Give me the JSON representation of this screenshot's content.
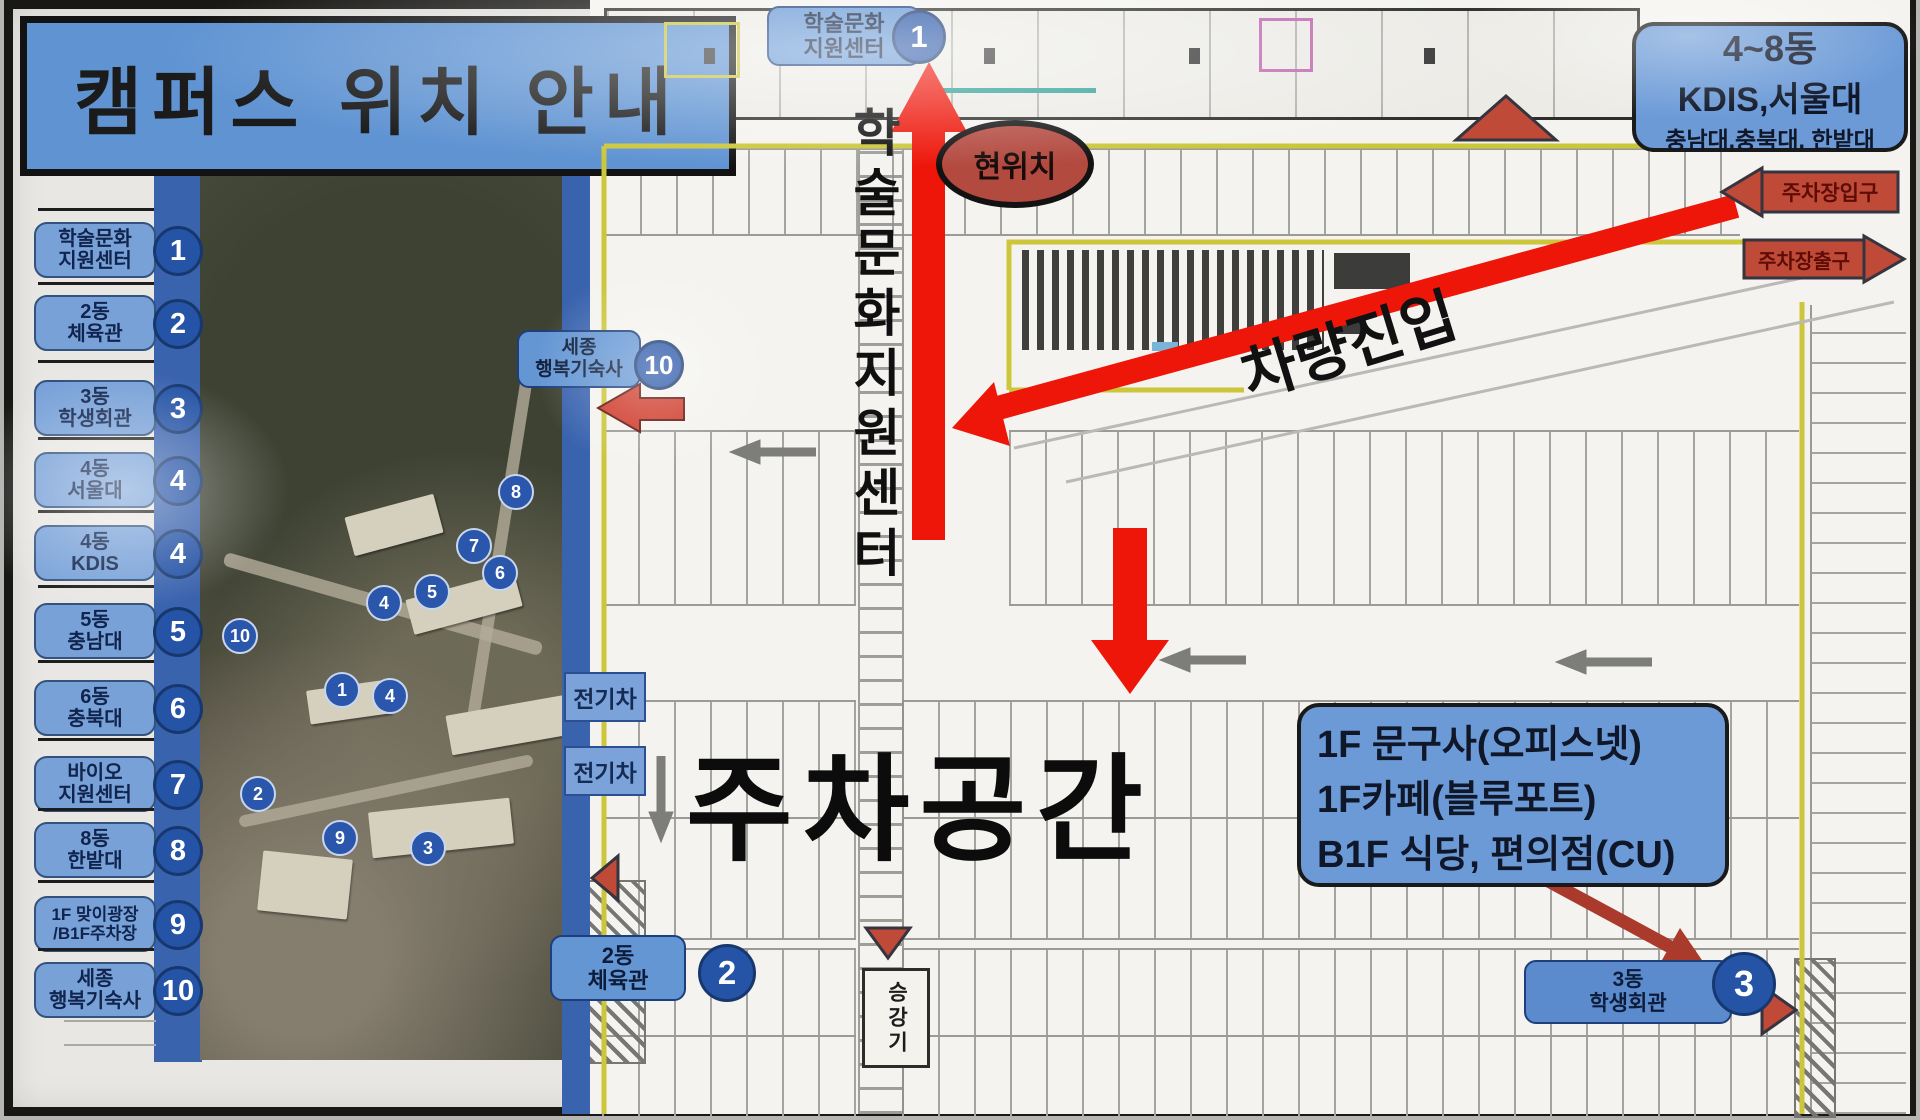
{
  "title": "캠퍼스 위치 안내",
  "legend": {
    "items": [
      {
        "line1": "학술문화",
        "line2": "지원센터",
        "num": "1"
      },
      {
        "line1": "2동",
        "line2": "체육관",
        "num": "2"
      },
      {
        "line1": "3동",
        "line2": "학생회관",
        "num": "3"
      },
      {
        "line1": "4동",
        "line2": "서울대",
        "num": "4"
      },
      {
        "line1": "4동",
        "line2": "KDIS",
        "num": "4"
      },
      {
        "line1": "5동",
        "line2": "충남대",
        "num": "5"
      },
      {
        "line1": "6동",
        "line2": "충북대",
        "num": "6"
      },
      {
        "line1": "바이오",
        "line2": "지원센터",
        "num": "7"
      },
      {
        "line1": "8동",
        "line2": "한밭대",
        "num": "8"
      },
      {
        "line1": "1F 맞이광장",
        "line2": "/B1F주차장",
        "num": "9"
      },
      {
        "line1": "세종",
        "line2": "행복기숙사",
        "num": "10"
      }
    ]
  },
  "photo": {
    "circles": [
      "10",
      "8",
      "7",
      "6",
      "5",
      "4",
      "4",
      "1",
      "2",
      "9",
      "3"
    ]
  },
  "map": {
    "top_badge": {
      "line1": "학술문화",
      "line2": "지원센터",
      "num": "1"
    },
    "current_location": "현위치",
    "vertical_route_label": "학술문화지원센터",
    "parking_area": "주차공간",
    "vehicle_entry": "차량진입",
    "entrance_label": "주차장입구",
    "exit_label": "주차장출구",
    "buildings_box": {
      "line1": "4~8동",
      "line2": "KDIS,서울대",
      "line3": "충남대,충북대, 한밭대"
    },
    "info_box": {
      "line1": "1F 문구사(오피스넷)",
      "line2": "1F카페(블루포트)",
      "line3": "B1F 식당, 편의점(CU)"
    },
    "ev_label": "전기차",
    "dorm_badge": {
      "line1": "세종",
      "line2": "행복기숙사",
      "num": "10"
    },
    "gym_badge": {
      "line1": "2동",
      "line2": "체육관",
      "num": "2"
    },
    "hall_badge": {
      "line1": "3동",
      "line2": "학생회관",
      "num": "3"
    },
    "elevator_label": "승강기"
  },
  "colors": {
    "badge_blue": "#6496d4",
    "circle_blue": "#2a57ab",
    "strip_blue": "#3a63ae",
    "arrow_red": "#ee1509",
    "sign_red": "#bf4a38",
    "oval_red": "#b34a40",
    "line_yellow": "#ccc63a"
  }
}
